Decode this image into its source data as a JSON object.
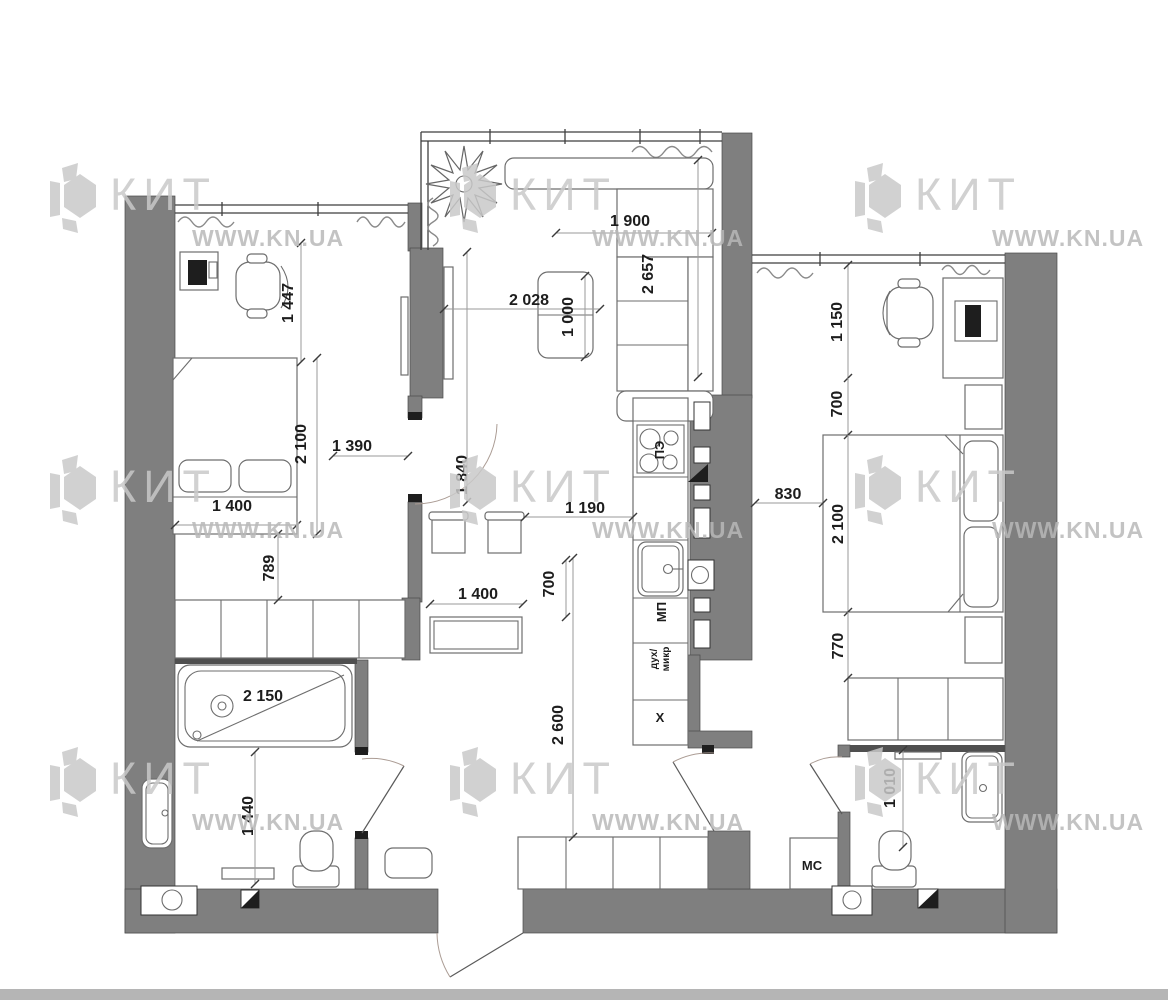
{
  "watermark": {
    "brand": "КИТ",
    "site": "WWW.KN.UA"
  },
  "colors": {
    "wall": "#7f7f7f",
    "watermark_logo": "#c9c9c9",
    "watermark_site": "#b9b9b9",
    "dim_text": "#1d1d1d",
    "photo_strip": "#b5b5b5",
    "background": "#ffffff"
  },
  "labels": {
    "stove": "ПЭ",
    "microwave": "МП",
    "oven_line1": "дух/",
    "oven_line2": "микр",
    "hood": "X",
    "storage": "МС"
  },
  "dims": {
    "bedroom1_window": "1 447",
    "bedroom1_bed_length": "2 100",
    "bedroom1_to_door": "1 390",
    "bedroom1_bed_width": "1 400",
    "bedroom1_bed_side": "789",
    "bathtub_length": "2 150",
    "bathroom1_width": "1 440",
    "living_sofa_width": "1 900",
    "living_sofa_length": "2 657",
    "living_width": "2 028",
    "coffee_table_length": "1 000",
    "kitchen_passage": "1 190",
    "bedroom1_door": "1 840",
    "dining_table_width": "1 400",
    "dining_depth": "700",
    "hallway_length": "2 600",
    "bedroom2_desk_zone": "1 150",
    "bedroom2_gap": "700",
    "bedroom2_passage": "830",
    "bedroom2_bed_length": "2 100",
    "bedroom2_wardrobe_side": "770",
    "bathroom2_width": "1 010"
  }
}
